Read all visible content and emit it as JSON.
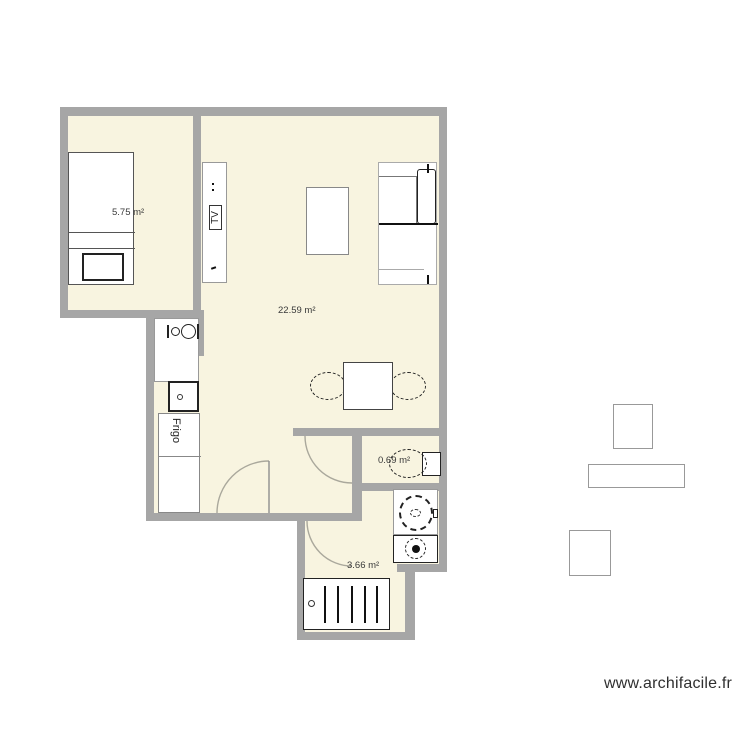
{
  "page": {
    "background": "#ffffff"
  },
  "colors": {
    "page_bg": "#ffffff",
    "wall": "#a6a6a6",
    "floor": "#f8f4e0",
    "door_arc": "#aaa89c",
    "label_text": "#3a3a3a",
    "watermark": "#2f2f2f",
    "appliance_line": "#222222"
  },
  "plan": {
    "rooms": [
      {
        "id": "bedroom",
        "area_label": "5.75 m²"
      },
      {
        "id": "living",
        "area_label": "22.59 m²"
      },
      {
        "id": "wc",
        "area_label": "0.69 m²"
      },
      {
        "id": "bathroom",
        "area_label": "3.66 m²"
      }
    ],
    "furniture_labels": {
      "tv": "TV",
      "fridge": "Frigo"
    }
  },
  "footer": {
    "watermark": "www.archifacile.fr"
  }
}
